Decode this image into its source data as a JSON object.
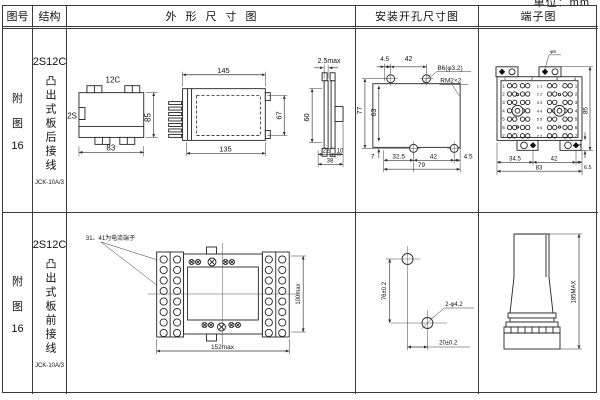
{
  "unit_label": "单位：mm",
  "header": {
    "figure": "图号",
    "structure": "结构",
    "outline": "外形尺寸图",
    "install": "安装开孔尺寸图",
    "terminal": "端子图"
  },
  "row1": {
    "figure": {
      "l1": "附",
      "l2": "图",
      "l3": "16"
    },
    "structure": {
      "model": "2S12C",
      "desc": "凸出式板后接线",
      "product": "JCK-10A/3"
    },
    "front_view": {
      "top": "12C",
      "left": "2S",
      "h": "85",
      "w": "83"
    },
    "side_view": {
      "top": "145",
      "bottom": "135",
      "h": "67"
    },
    "panel_view": {
      "t": "2.5max",
      "h": "60",
      "a": "22",
      "b": "10",
      "c": "38"
    },
    "install": {
      "t1": "4.5",
      "t2": "42",
      "hole": "B6(φ3.2)",
      "thread": "RM2×2",
      "v1": "77",
      "v2": "63",
      "v3": "7",
      "b1": "32.5",
      "b2": "42",
      "b3": "4.5",
      "b4": "79"
    },
    "terminal": {
      "screw": "φ6",
      "h": "85",
      "foot": "4",
      "b1": "34.5",
      "b2": "42",
      "b3": "6.5",
      "b4": "83",
      "rows": [
        "1",
        "2",
        "3",
        "4",
        "5",
        "6",
        "7"
      ],
      "mids": [
        "1 1",
        "2 2",
        "3 3",
        "4 4",
        "5 5",
        "6 6",
        "7 7"
      ],
      "cols": [
        "1",
        "2",
        "3",
        "4"
      ]
    }
  },
  "row2": {
    "figure": {
      "l1": "附",
      "l2": "图",
      "l3": "16"
    },
    "structure": {
      "model": "2S12C",
      "desc": "凸出式板前接线",
      "product": "JCK-10A/3"
    },
    "outline": {
      "note": "31、41为电流端子",
      "w": "152max",
      "h": "100max"
    },
    "install": {
      "v": "76±0.2",
      "b": "20±0.2",
      "hole": "2-φ4.2"
    },
    "terminal": {
      "h": "185MAX"
    }
  }
}
